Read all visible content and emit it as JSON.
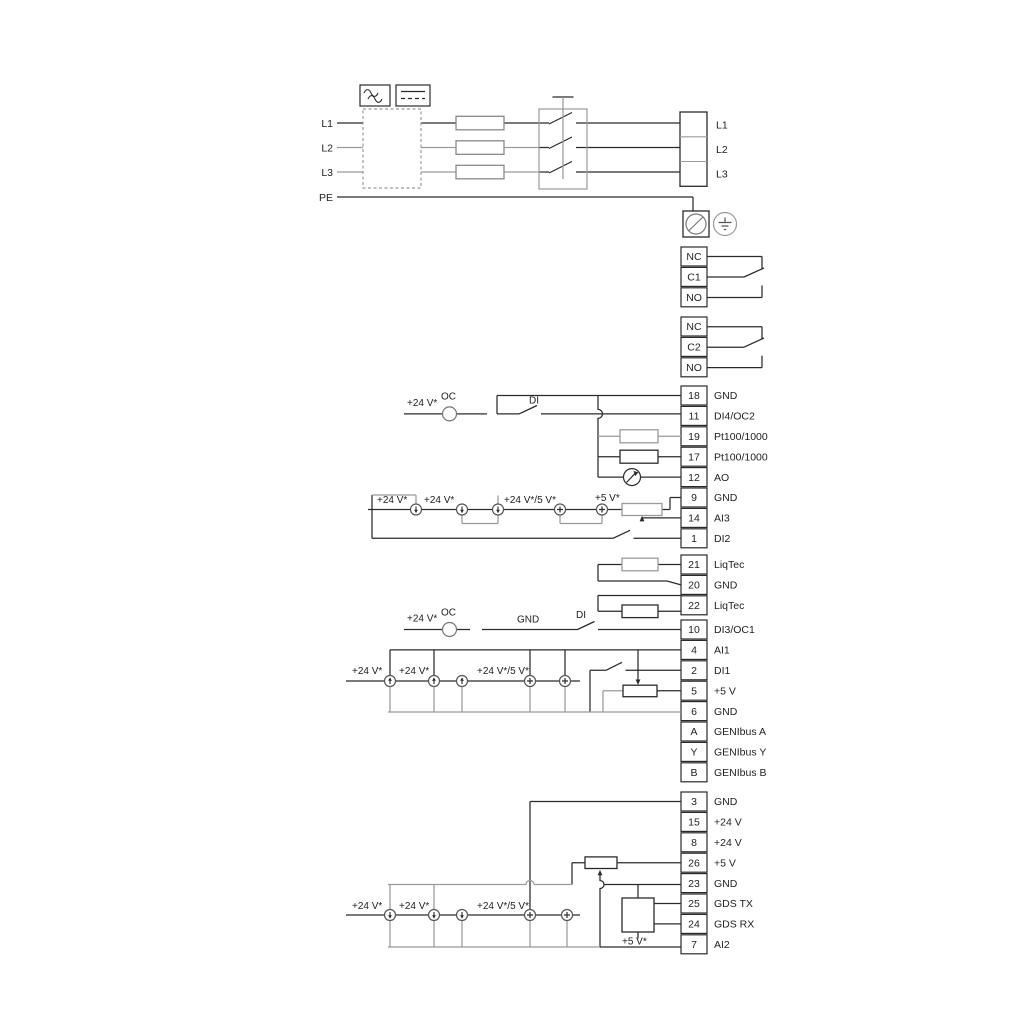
{
  "colors": {
    "line": "#2b2b2b",
    "gray": "#9b9b9b",
    "fuse": "#8a8a8a",
    "bg": "#ffffff"
  },
  "power_in": [
    "L1",
    "L2",
    "L3",
    "PE"
  ],
  "power_out": [
    "L1",
    "L2",
    "L3"
  ],
  "relay1": [
    {
      "n": "NC"
    },
    {
      "n": "C1"
    },
    {
      "n": "NO"
    }
  ],
  "relay2": [
    {
      "n": "NC"
    },
    {
      "n": "C2"
    },
    {
      "n": "NO"
    }
  ],
  "io1": [
    {
      "n": "18",
      "l": "GND"
    },
    {
      "n": "11",
      "l": "DI4/OC2"
    },
    {
      "n": "19",
      "l": "Pt100/1000"
    },
    {
      "n": "17",
      "l": "Pt100/1000"
    },
    {
      "n": "12",
      "l": "AO"
    },
    {
      "n": "9",
      "l": "GND"
    },
    {
      "n": "14",
      "l": "AI3"
    },
    {
      "n": "1",
      "l": "DI2"
    }
  ],
  "io2": [
    {
      "n": "21",
      "l": "LiqTec"
    },
    {
      "n": "20",
      "l": "GND"
    },
    {
      "n": "22",
      "l": "LiqTec"
    }
  ],
  "io3": [
    {
      "n": "10",
      "l": "DI3/OC1"
    },
    {
      "n": "4",
      "l": "AI1"
    },
    {
      "n": "2",
      "l": "DI1"
    },
    {
      "n": "5",
      "l": "+5 V"
    },
    {
      "n": "6",
      "l": "GND"
    },
    {
      "n": "A",
      "l": "GENIbus A"
    },
    {
      "n": "Y",
      "l": "GENIbus Y"
    },
    {
      "n": "B",
      "l": "GENIbus B"
    }
  ],
  "io4": [
    {
      "n": "3",
      "l": "GND"
    },
    {
      "n": "15",
      "l": "+24 V"
    },
    {
      "n": "8",
      "l": "+24 V"
    },
    {
      "n": "26",
      "l": "+5 V"
    },
    {
      "n": "23",
      "l": "GND"
    },
    {
      "n": "25",
      "l": "GDS TX"
    },
    {
      "n": "24",
      "l": "GDS RX"
    },
    {
      "n": "7",
      "l": "AI2"
    }
  ],
  "ann": {
    "v24": "+24 V*",
    "v24v5": "+24 V*/5 V*",
    "v5": "+5 V*",
    "oc": "OC",
    "di": "DI",
    "gnd": "GND"
  }
}
